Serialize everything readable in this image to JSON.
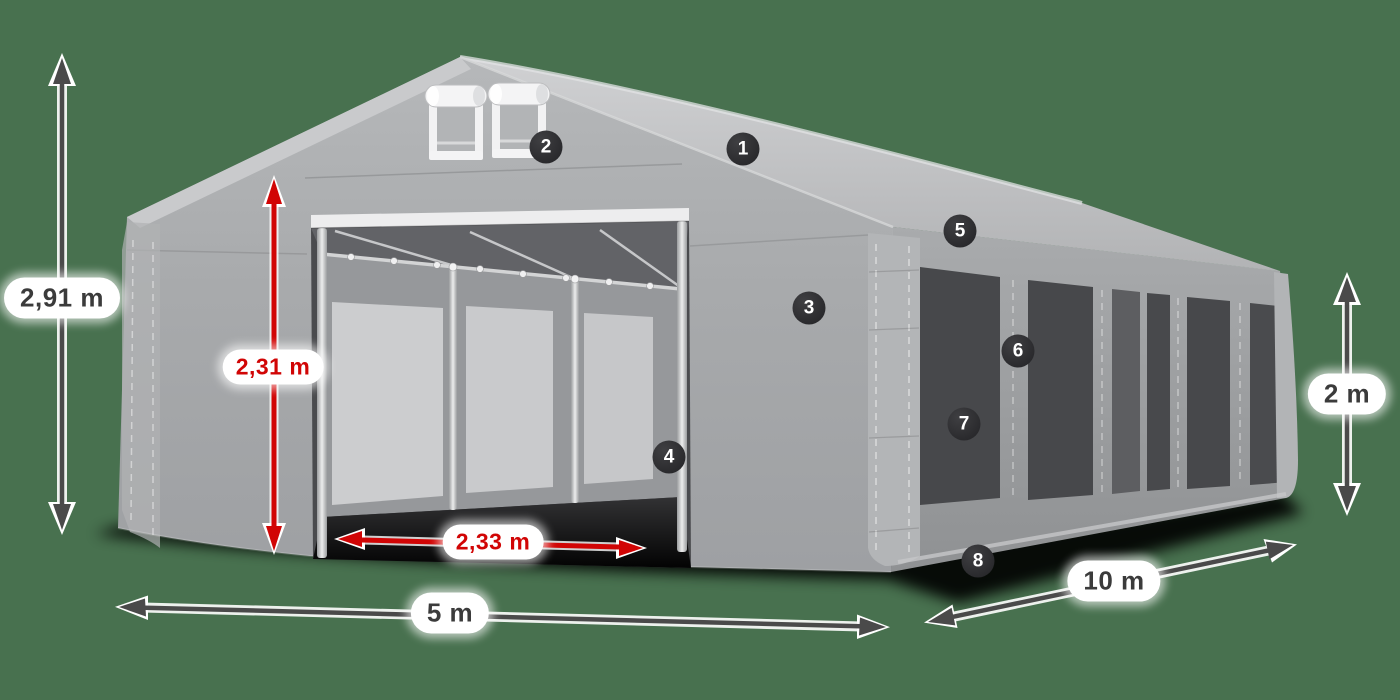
{
  "product": {
    "type_hint": "party-tent-diagram"
  },
  "dimensions": {
    "total_height": "2,91 m",
    "door_height": "2,31 m",
    "door_width": "2,33 m",
    "gable_width": "5 m",
    "side_length": "10 m",
    "side_height": "2 m"
  },
  "tent": {
    "callouts": [
      {
        "number": "1"
      },
      {
        "number": "2"
      },
      {
        "number": "3"
      },
      {
        "number": "4"
      },
      {
        "number": "5"
      },
      {
        "number": "6"
      },
      {
        "number": "7"
      },
      {
        "number": "8"
      }
    ]
  },
  "colors": {
    "background": "#48714f",
    "dimension_red": "#d10505",
    "dimension_dark": "#4a4a4a",
    "badge_background": "#2a2a2c",
    "label_text": "#3b3b3b",
    "tent_roof": "#c3c4c6",
    "tent_wall": "#a5a7a9",
    "window_dark": "#47484b"
  }
}
